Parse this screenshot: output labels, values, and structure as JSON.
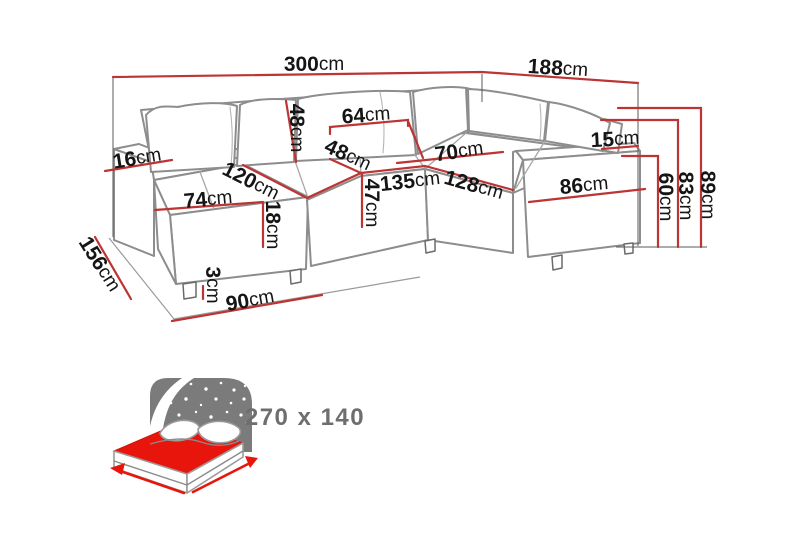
{
  "colors": {
    "dimension_red": "#bc3434",
    "sofa_line_gray": "#8d8d8d",
    "label_black": "#151515",
    "icon_gray": "#7b7b7b",
    "icon_red": "#e8150d",
    "bed_text_gray": "#6e6e6e"
  },
  "dims": {
    "total_width": {
      "v": "300",
      "u": "cm"
    },
    "right_depth": {
      "v": "188",
      "u": "cm"
    },
    "back_cushion_height": {
      "v": "48",
      "u": "cm"
    },
    "back_cushion_width": {
      "v": "64",
      "u": "cm"
    },
    "left_armrest_width": {
      "v": "16",
      "u": "cm"
    },
    "seat_depth": {
      "v": "48",
      "u": "cm"
    },
    "chaise_length": {
      "v": "120",
      "u": "cm"
    },
    "chaise_width": {
      "v": "74",
      "u": "cm"
    },
    "chaise_cushion_height": {
      "v": "18",
      "u": "cm"
    },
    "middle_seat_width": {
      "v": "135",
      "u": "cm"
    },
    "right_seat_depth": {
      "v": "70",
      "u": "cm"
    },
    "right_section_length": {
      "v": "128",
      "u": "cm"
    },
    "seat_height": {
      "v": "47",
      "u": "cm"
    },
    "right_armrest_length": {
      "v": "86",
      "u": "cm"
    },
    "right_armrest_width": {
      "v": "15",
      "u": "cm"
    },
    "armrest_height": {
      "v": "60",
      "u": "cm"
    },
    "backrest_height": {
      "v": "83",
      "u": "cm"
    },
    "total_height": {
      "v": "89",
      "u": "cm"
    },
    "left_depth": {
      "v": "156",
      "u": "cm"
    },
    "leg_height": {
      "v": "3",
      "u": "cm"
    },
    "chaise_floor_length": {
      "v": "90",
      "u": "cm"
    }
  },
  "sleeping_function": {
    "bed_size": "270 x 140"
  }
}
